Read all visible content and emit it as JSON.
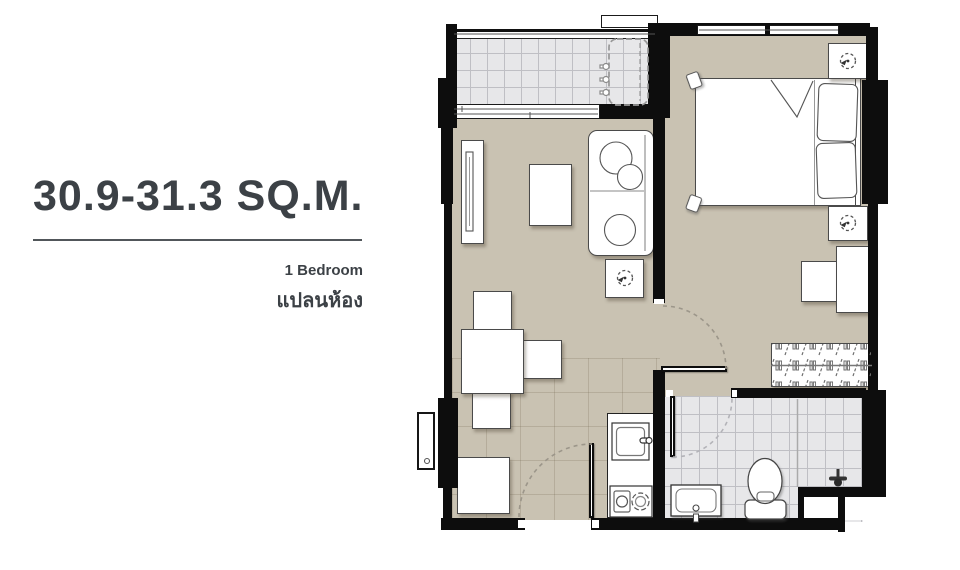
{
  "info": {
    "area_range": "30.9-31.3 SQ.M.",
    "unit_type": "1 Bedroom",
    "unit_type_thai": "แปลนห้อง"
  },
  "palette": {
    "wall": "#0d0d0d",
    "floor_main": "#c9c2b2",
    "floor_tile": "#e7e7e9",
    "tile_line": "#bfbfc4",
    "furniture_outline": "#4a4a4a",
    "door_arc": "#9c968a",
    "text": "#3c4146"
  },
  "floorplan": {
    "rooms": [
      "balcony",
      "living-dining-area",
      "kitchen",
      "bedroom",
      "wardrobe-corridor",
      "bathroom"
    ],
    "fixtures": [
      "washing-machine",
      "sliding-glass-door",
      "tv-console",
      "coffee-table",
      "sofa",
      "side-table-with-lamp",
      "dining-table",
      "dining-chairs",
      "storage-cabinet",
      "kitchen-counter",
      "kitchen-sink",
      "two-burner-stove",
      "entry-door",
      "double-bed",
      "pillows",
      "nightstand-with-lamp",
      "desk",
      "desk-chair",
      "wardrobe",
      "bedroom-door",
      "bathroom-door",
      "washbasin",
      "toilet",
      "shower-mixer",
      "service-shaft",
      "ac-ledge"
    ]
  },
  "icons": [
    "lamp-icon",
    "door-swing-arc",
    "hanger-pattern",
    "shower-mixer-icon",
    "sink-faucet-icon",
    "stove-burners-icon",
    "washing-machine-outline"
  ]
}
